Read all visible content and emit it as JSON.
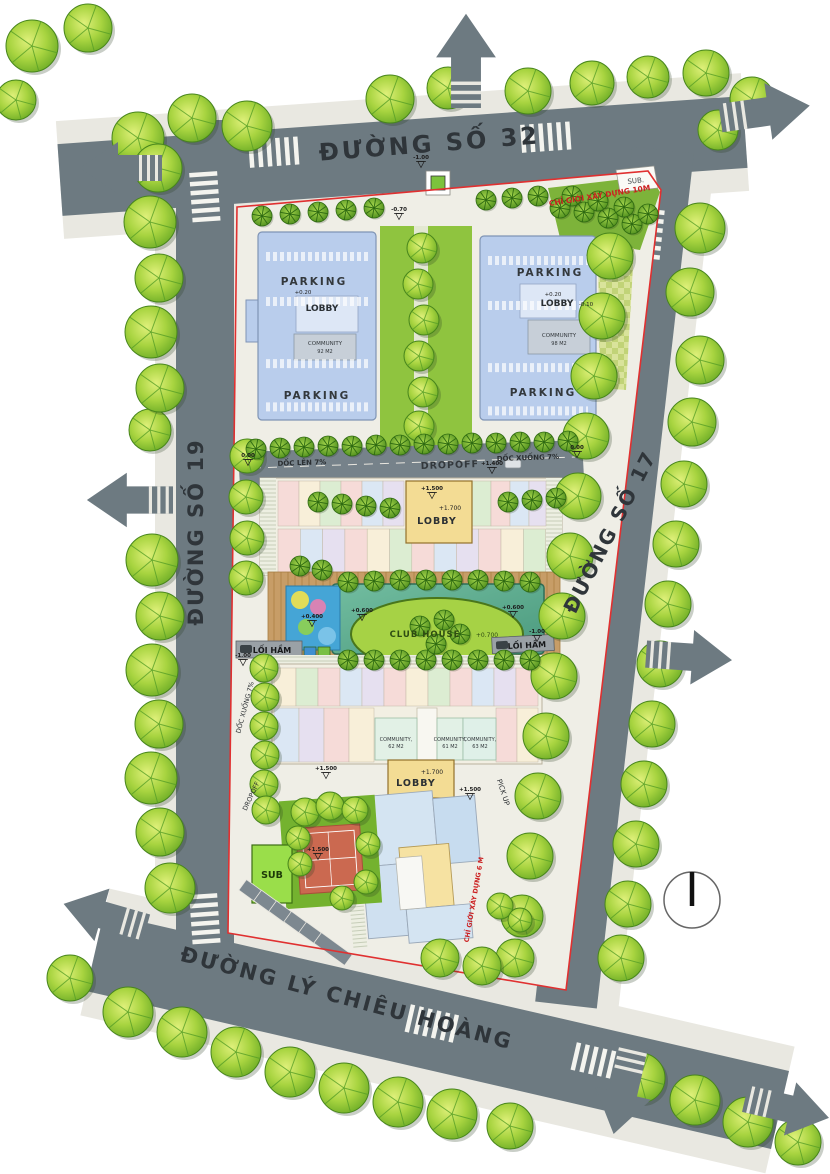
{
  "plan": {
    "streets": {
      "top": "ĐƯỜNG SỐ 32",
      "left": "ĐƯỜNG SỐ 19",
      "right": "ĐƯỜNG SỐ 17",
      "bottom": "ĐƯỜNG LÝ CHIÊU HOÀNG"
    },
    "annotations": {
      "setback_10m": "CHỈ GIỚI XÂY DỰNG 10M",
      "setback_6m": "CHỈ GIỚI XÂY DỰNG 6 M",
      "sub_top": "SUB.",
      "sub_station": "SUB",
      "ramp_up": "DỐC LÊN 7%",
      "ramp_down": "DỐC XUỐNG 7%",
      "ramp_down_side": "DỐC XUỐNG 7%",
      "dropoff": "DROPOFF",
      "dropoff_side": "DROPOFF",
      "pickup": "PICK UP",
      "tunnel_left": "LỐI HẦM",
      "tunnel_right": "LỐI HẦM",
      "club_house": "CLUB HOUSE",
      "club_house_level": "+0.700"
    },
    "parking_left": {
      "parking_top": "PARKING",
      "lobby": "LOBBY",
      "lobby_level": "+0.20",
      "community": "COMMUNITY",
      "community_area": "92 M2",
      "parking_bottom": "PARKING"
    },
    "parking_right": {
      "parking_top": "PARKING",
      "lobby": "LOBBY",
      "lobby_level": "+0.20",
      "lobby_level2": "-0.10",
      "community": "COMMUNITY",
      "community_area": "98 M2",
      "parking_bottom": "PARKING"
    },
    "block_upper": {
      "lobby": "LOBBY",
      "lobby_level": "+1.700"
    },
    "block_lower": {
      "lobby": "LOBBY",
      "lobby_level": "+1.700",
      "community_1": "COMMUNITY,",
      "community_1_area": "62 M2",
      "community_2": "COMMUNITY,",
      "community_2_area": "61 M2",
      "community_3": "COMMUNITY,",
      "community_3_area": "63 M2"
    },
    "levels": [
      {
        "v": "-1.00",
        "x": 421,
        "y": 159
      },
      {
        "v": "-0.70",
        "x": 399,
        "y": 211
      },
      {
        "v": "0.00",
        "x": 248,
        "y": 457
      },
      {
        "v": "0.00",
        "x": 577,
        "y": 449
      },
      {
        "v": "+1.400",
        "x": 492,
        "y": 465
      },
      {
        "v": "+1.500",
        "x": 432,
        "y": 490
      },
      {
        "v": "+0.600",
        "x": 362,
        "y": 612
      },
      {
        "v": "+0.600",
        "x": 513,
        "y": 609
      },
      {
        "v": "+0.400",
        "x": 312,
        "y": 618
      },
      {
        "v": "-1.00",
        "x": 243,
        "y": 657
      },
      {
        "v": "-1.00",
        "x": 537,
        "y": 633
      },
      {
        "v": "+1.500",
        "x": 326,
        "y": 770
      },
      {
        "v": "+1.500",
        "x": 470,
        "y": 791
      },
      {
        "v": "+1.500",
        "x": 318,
        "y": 851
      }
    ],
    "colors": {
      "road": "#6d7a81",
      "sidewalk": "#e9e8e1",
      "parking_building": "#b9cdec",
      "lobby_yellow": "#f3dc94",
      "pool": "#5fae92",
      "boundary_red": "#e03030",
      "tree_green": "#8cc63f",
      "court_red": "#cb6950",
      "sub_green": "#9ade4a"
    }
  }
}
